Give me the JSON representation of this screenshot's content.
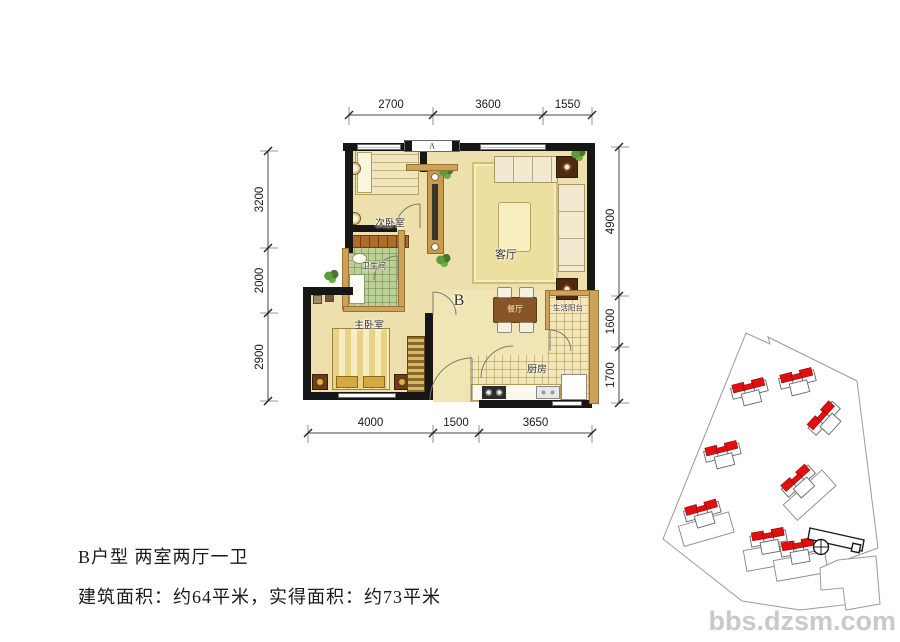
{
  "plan": {
    "rooms": {
      "secondary_bedroom": "次卧室",
      "living_room": "客厅",
      "bathroom": "卫生间",
      "master_bedroom": "主卧室",
      "dining_room": "餐厅",
      "balcony": "生活阳台",
      "kitchen": "厨房"
    },
    "unit_marker": "B",
    "window_marker": "A",
    "dimensions": {
      "top": [
        "2700",
        "3600",
        "1550"
      ],
      "left": [
        "3200",
        "2000",
        "2900"
      ],
      "right": [
        "4900",
        "1600",
        "1700"
      ],
      "bottom": [
        "4000",
        "1500",
        "3650"
      ]
    }
  },
  "footer": {
    "line1": "B户型 两室两厅一卫",
    "line2": "建筑面积：约64平米，实得面积：约73平米"
  },
  "watermark": "bbs.dzsm.com",
  "site_plan": {
    "highlight_color": "#e01010",
    "buildings": [
      {
        "x": 750,
        "y": 392,
        "angle": -14,
        "podium": false
      },
      {
        "x": 798,
        "y": 382,
        "angle": -14,
        "podium": false
      },
      {
        "x": 826,
        "y": 420,
        "angle": -48,
        "podium": false
      },
      {
        "x": 723,
        "y": 455,
        "angle": -14,
        "podium": false
      },
      {
        "x": 800,
        "y": 483,
        "angle": -42,
        "podium": true
      },
      {
        "x": 703,
        "y": 514,
        "angle": -16,
        "podium": true
      },
      {
        "x": 769,
        "y": 541,
        "angle": -10,
        "podium": true
      },
      {
        "x": 799,
        "y": 551,
        "angle": -10,
        "podium": true
      }
    ]
  },
  "colors": {
    "wall": "#161616",
    "floor": "#ede0ac",
    "bath_tile": "#bccf97",
    "wood": "#cfa25c",
    "roof_red": "#e01010",
    "watermark_gray": "#c9c9c9"
  }
}
